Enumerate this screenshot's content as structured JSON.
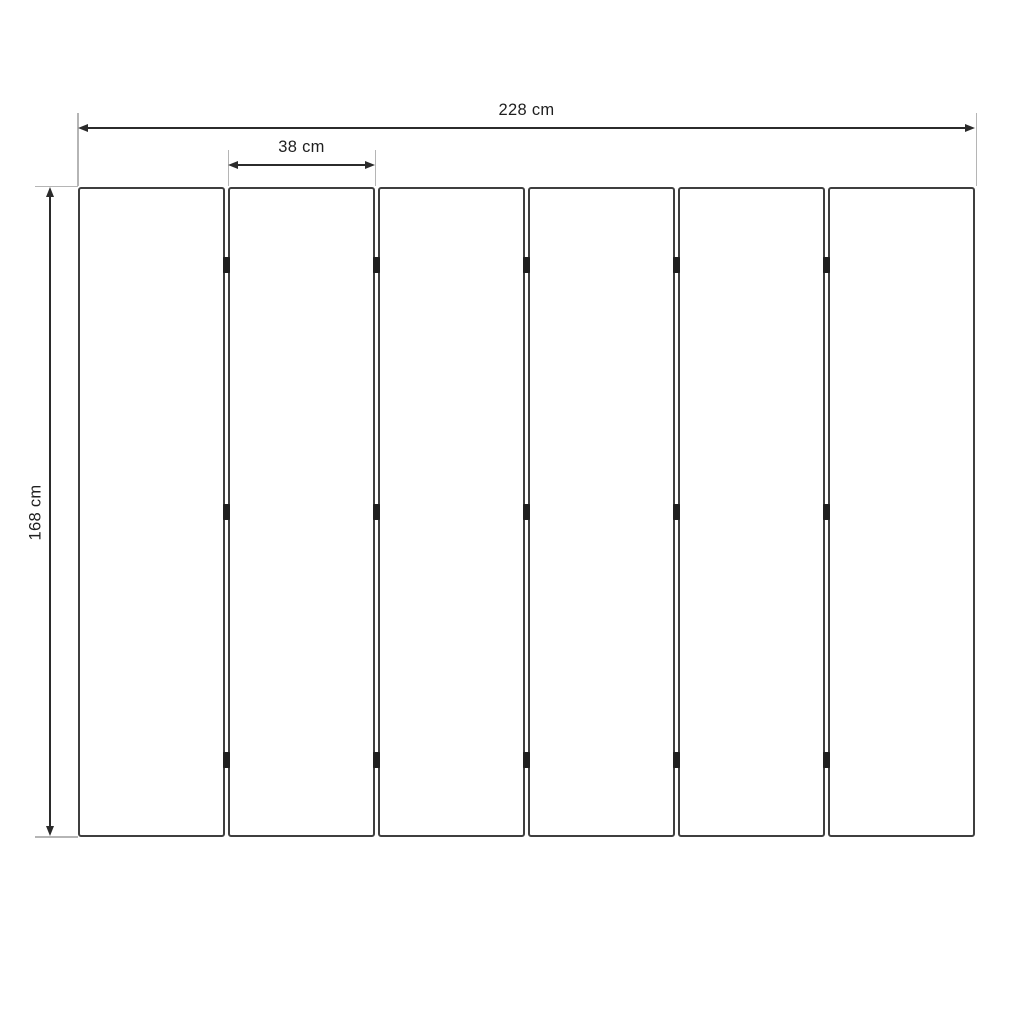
{
  "diagram": {
    "type": "technical-dimension-drawing",
    "subject": "six-panel folding screen, front view",
    "panel_count": 6,
    "hinge_rows_per_joint": 3,
    "labels": {
      "total_width": "228 cm",
      "panel_width": "38 cm",
      "height": "168 cm"
    },
    "colors": {
      "background": "#ffffff",
      "panel_border": "#3f3f3f",
      "panel_fill": "#ffffff",
      "hinge": "#1f1f1f",
      "dimension_line": "#2b2b2b",
      "extension_line": "#b5b5b5",
      "text": "#1f1f1f"
    }
  }
}
